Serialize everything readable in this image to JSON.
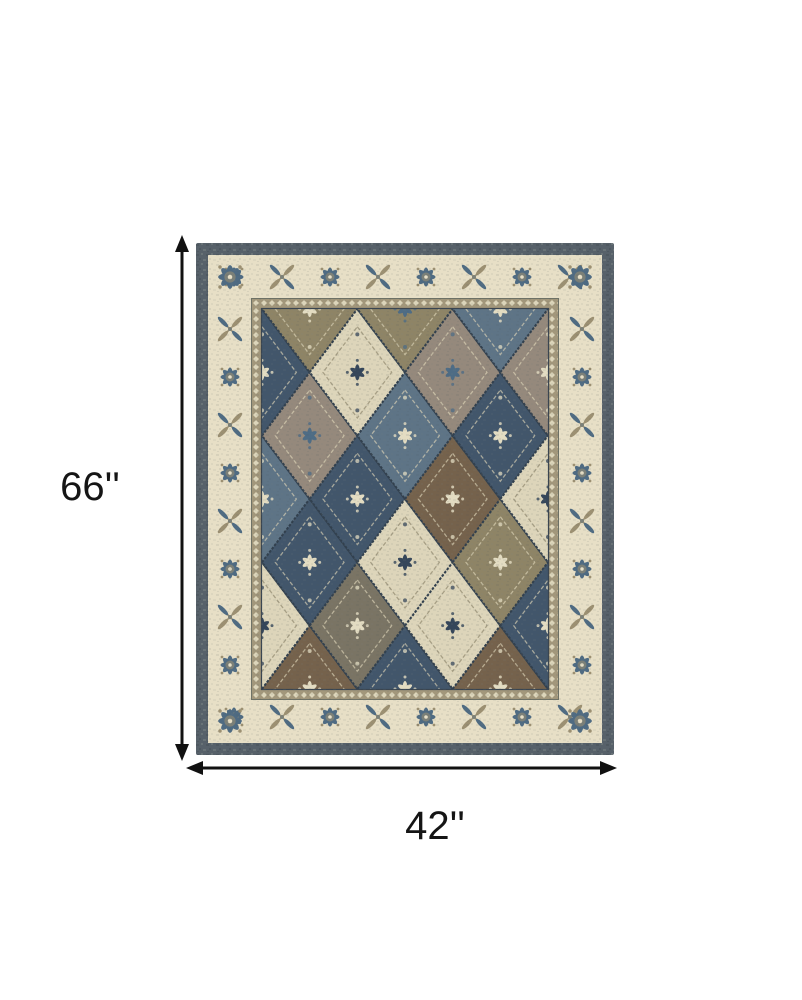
{
  "page": {
    "background": "#ffffff"
  },
  "dimension_labels": {
    "height": "66''",
    "width": "42''"
  },
  "dimension_lines": {
    "color": "#111111"
  },
  "rug": {
    "edge_color": "#57616a",
    "edge_mottle_dark": "#49525a",
    "edge_mottle_light": "#76807f",
    "border_ivory": "#e7dfc6",
    "border_motif_blue": "#4f6b82",
    "border_motif_taupe": "#9c9072",
    "border_motif_gray": "#7b8078",
    "guard_color": "#a2977b",
    "guard_dot": "#e7dfc6",
    "field_base": "#4a5a68",
    "panel_palette": [
      "#42566b",
      "#8e8466",
      "#ddd5ba",
      "#75624c",
      "#95897c",
      "#5e7486",
      "#7a7464"
    ],
    "medallion_palette": [
      "#e3dcc2",
      "#35465a",
      "#4e6c85",
      "#7d7354"
    ],
    "panel_sequence": [
      0,
      5,
      2,
      1,
      4,
      0,
      3,
      2,
      0,
      6,
      1,
      5,
      2,
      0,
      4,
      3,
      2,
      5,
      0,
      1,
      3,
      4,
      2,
      0
    ]
  }
}
